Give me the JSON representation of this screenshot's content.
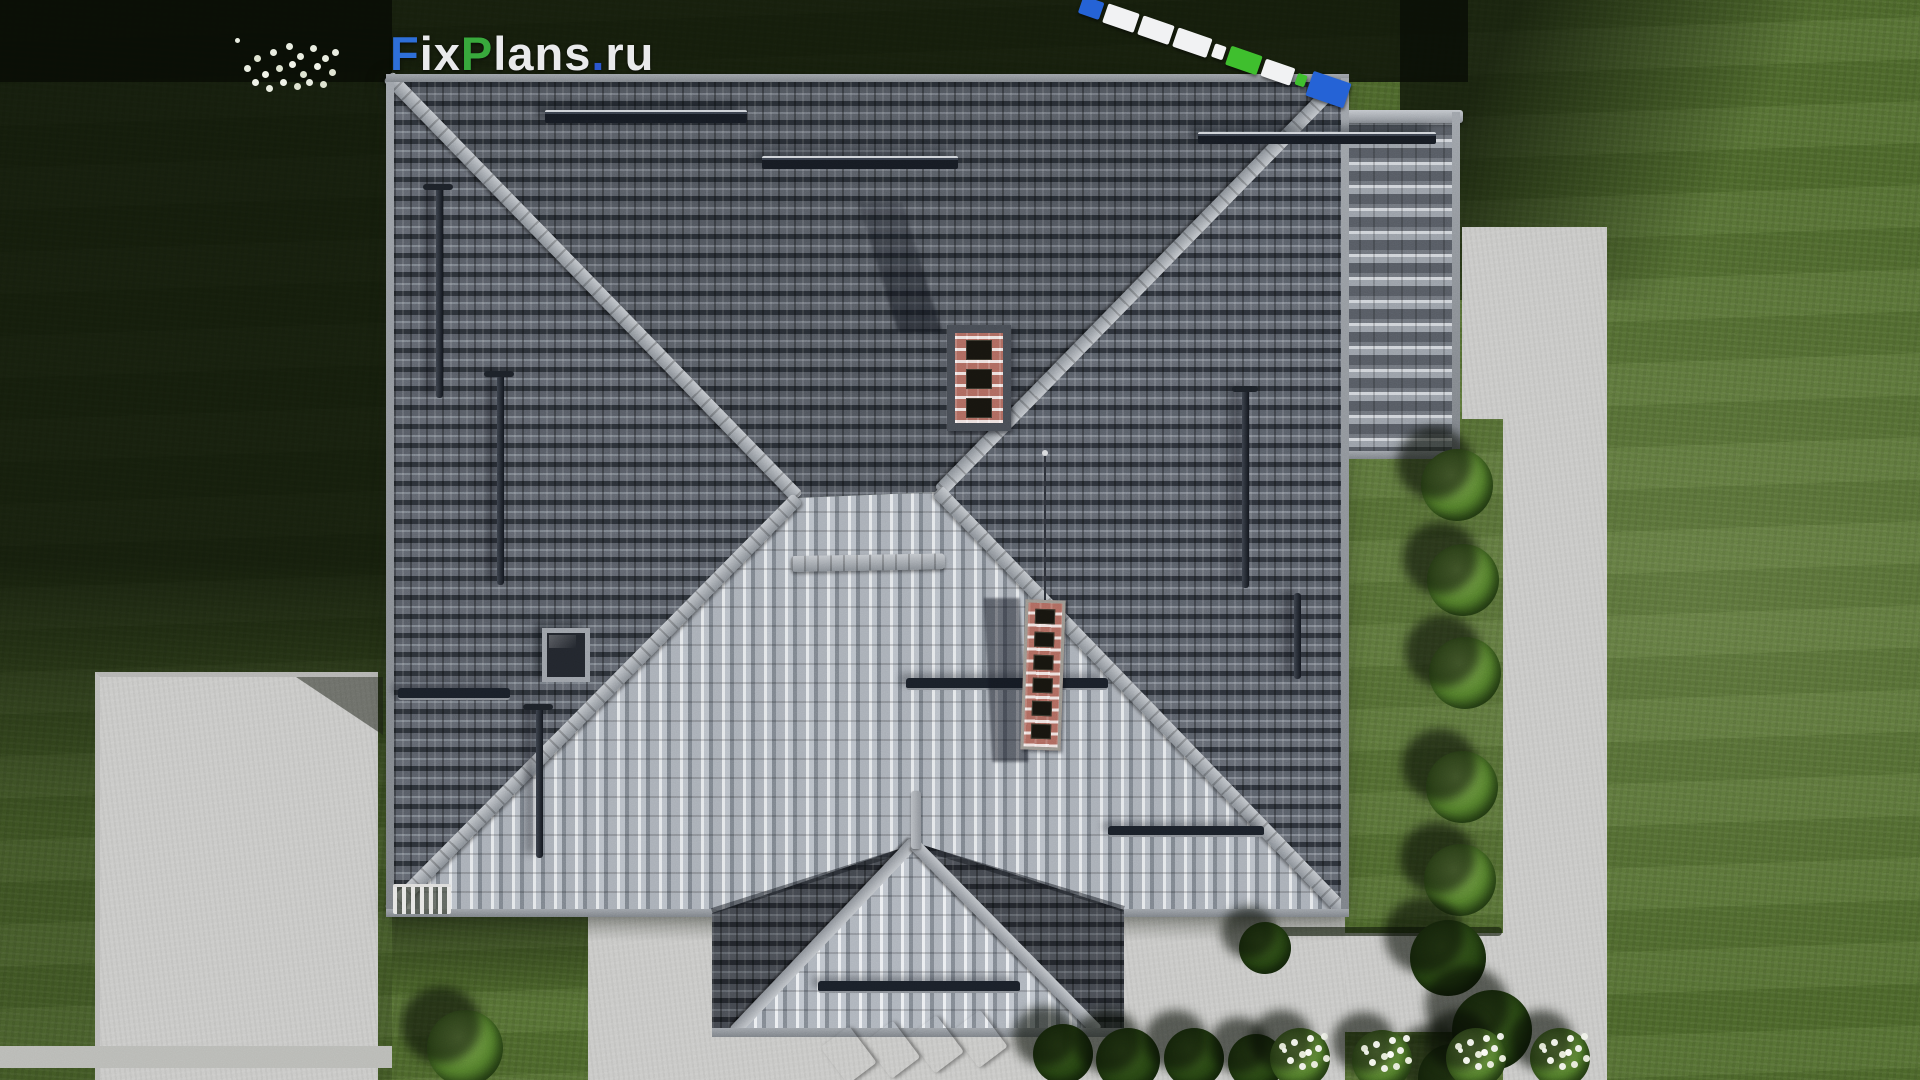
{
  "watermark_logo": {
    "full_text": "FixPlans.ru",
    "segments": [
      {
        "text": "F",
        "color": "#2e6fd8"
      },
      {
        "text": "ix",
        "color": "#e9eaec"
      },
      {
        "text": "P",
        "color": "#38a93c"
      },
      {
        "text": "lans",
        "color": "#e9eaec"
      },
      {
        "text": ".",
        "color": "#2b57d0"
      },
      {
        "text": "ru",
        "color": "#e9eaec"
      }
    ]
  },
  "scene": {
    "view": "top-down aerial 3D render",
    "subject": "house with gray tiled hip roof, front porch gable, garage wing, lawn, concrete paths and patio",
    "chimneys": 2,
    "chimney_flues": [
      3,
      6
    ],
    "roof_snow_bars": 7,
    "roof_vent_pipes": 5,
    "skylights": 1,
    "shrub_row_right_count": 5,
    "flower_bushes_bottom_count": 4
  },
  "palette": {
    "grass_lit": "#4f6a2c",
    "grass_shadow": "#12200a",
    "concrete": "#c9c9c7",
    "roof_dark": "#5a5f68",
    "roof_light": "#b2b8c0",
    "ridge_cap": "#9298a0",
    "chimney_brick": "#b4837a",
    "marker_navy": "#1d2438",
    "marker_blue": "#2563d6",
    "marker_cyan": "#2ea7e8",
    "marker_green": "#3fbf2e",
    "marker_white": "#f1f2f3"
  }
}
